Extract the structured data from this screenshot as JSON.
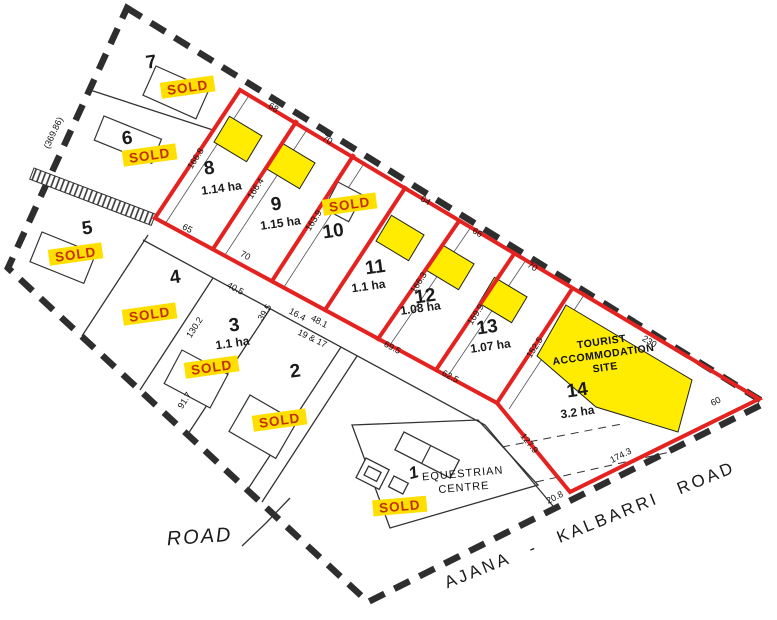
{
  "sold_label": "SOLD",
  "sold_lots": [
    "1",
    "2",
    "3",
    "4",
    "5",
    "6",
    "7",
    "10"
  ],
  "lots": {
    "1": {
      "num": "1"
    },
    "2": {
      "num": "2"
    },
    "3": {
      "num": "3",
      "area": "1.1 ha"
    },
    "4": {
      "num": "4"
    },
    "5": {
      "num": "5"
    },
    "6": {
      "num": "6"
    },
    "7": {
      "num": "7"
    },
    "8": {
      "num": "8",
      "area": "1.14 ha"
    },
    "9": {
      "num": "9",
      "area": "1.15 ha"
    },
    "10": {
      "num": "10"
    },
    "11": {
      "num": "11",
      "area": "1.1 ha"
    },
    "12": {
      "num": "12",
      "area": "1.08 ha"
    },
    "13": {
      "num": "13",
      "area": "1.07 ha"
    },
    "14": {
      "num": "14",
      "area": "3.2 ha"
    }
  },
  "tourist_site": {
    "line1": "TOURIST",
    "line2": "ACCOMMODATION",
    "line3": "SITE"
  },
  "equestrian_centre": {
    "line1": "EQUESTRIAN",
    "line2": "CENTRE"
  },
  "roads": {
    "minor_road_label": "ROAD",
    "main_road_label": "AJANA - KALBARRI ROAD"
  },
  "dimensions": {
    "left_boundary": "(369.86)",
    "top_8": "68",
    "top_9": "70",
    "top_11": "64",
    "top_12": "66",
    "top_13": "70",
    "top_14": "230",
    "corner_60": "60",
    "side_7_8": "166.8",
    "side_8_9": "166.4",
    "side_9_10": "163.9",
    "side_11_12": "166.3",
    "side_12_13": "169.9",
    "side_13_14": "152.5",
    "side_14_west": "127.9",
    "frontage_20_8": "20.8",
    "frontage_174_3": "174.3",
    "bottom_8": "65",
    "bottom_9": "70",
    "bottom_16_4": "16.4",
    "bottom_48_1": "48.1",
    "bottom_69_5": "69.5",
    "bottom_62_5": "62.5",
    "lot3_40_5": "40.5",
    "lot3_39_5": "39.5",
    "lot3_130_2": "130.2",
    "lot3_91_7": "91.7",
    "road_widths": "19 & 17"
  },
  "colors": {
    "stage_boundary_red": "#e42320",
    "boundary_dash": "#2e2e2e",
    "sold_tag_bg": "#ffdf00",
    "sold_tag_text": "#c33000",
    "building_envelope_yellow": "#ffec00",
    "tourist_site_yellow": "#ffec00"
  }
}
